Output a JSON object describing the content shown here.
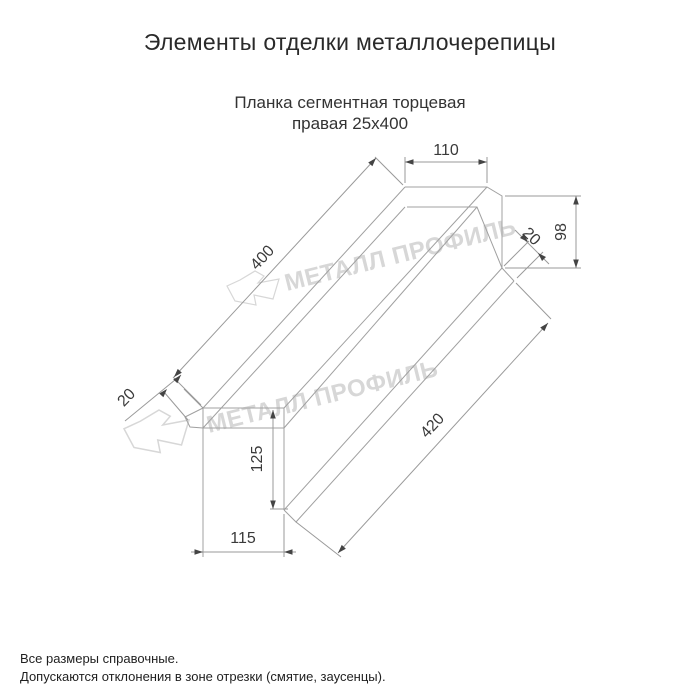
{
  "title": "Элементы отделки металлочерепицы",
  "product": {
    "name_line1": "Планка сегментная торцевая",
    "name_line2": "правая 25х400"
  },
  "dimensions": {
    "top_flange_width": "110",
    "right_end_height": "98",
    "top_length": "400",
    "right_hem": "20",
    "left_hem": "20",
    "bottom_length": "420",
    "left_end_height": "125",
    "bottom_width": "115"
  },
  "watermark": {
    "text": "МЕТАЛЛ ПРОФИЛЬ",
    "color": "#d7d7d7"
  },
  "colors": {
    "line": "#a0a0a0",
    "dimension_text": "#3a3a3a",
    "title_text": "#2a2a2a",
    "background": "#ffffff"
  },
  "footer": {
    "note1": "Все размеры справочные.",
    "note2": "Допускаются отклонения в зоне отрезки (смятие, заусенцы)."
  }
}
